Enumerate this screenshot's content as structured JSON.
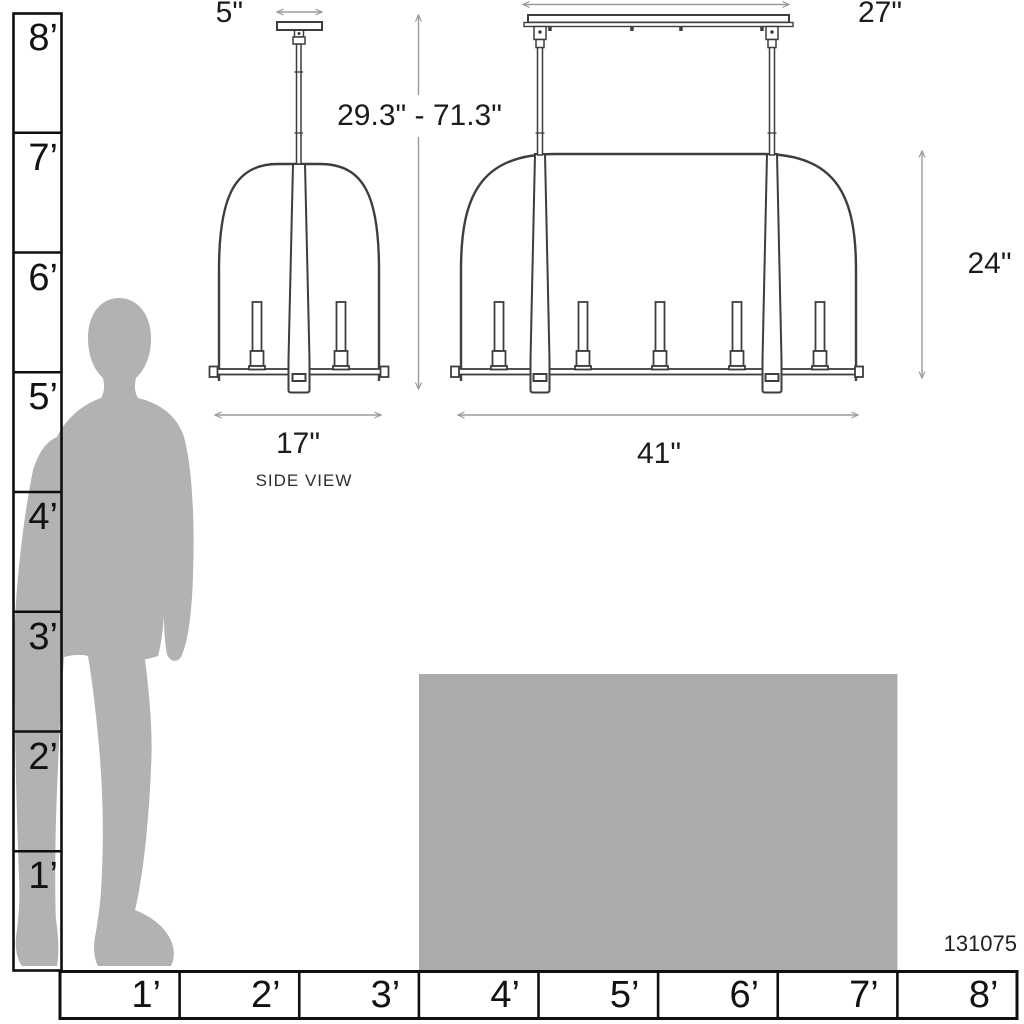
{
  "diagram": {
    "product_id": "131075",
    "side_view": {
      "label": "SIDE VIEW",
      "canopy_width": "5\"",
      "fixture_width": "17\"",
      "hanging_height_range": "29.3\" - 71.3\""
    },
    "front_view": {
      "canopy_width": "27\"",
      "fixture_width": "41\"",
      "fixture_height": "24\""
    },
    "rulers": {
      "vertical": [
        "8’",
        "7’",
        "6’",
        "5’",
        "4’",
        "3’",
        "2’",
        "1’"
      ],
      "horizontal": [
        "1’",
        "2’",
        "3’",
        "4’",
        "5’",
        "6’",
        "7’",
        "8’"
      ]
    },
    "colors": {
      "silhouette": "#b2b2b2",
      "island": "#ababab",
      "line_art": "#3e3e3e",
      "dimension_lines": "#9b9b9b"
    }
  }
}
